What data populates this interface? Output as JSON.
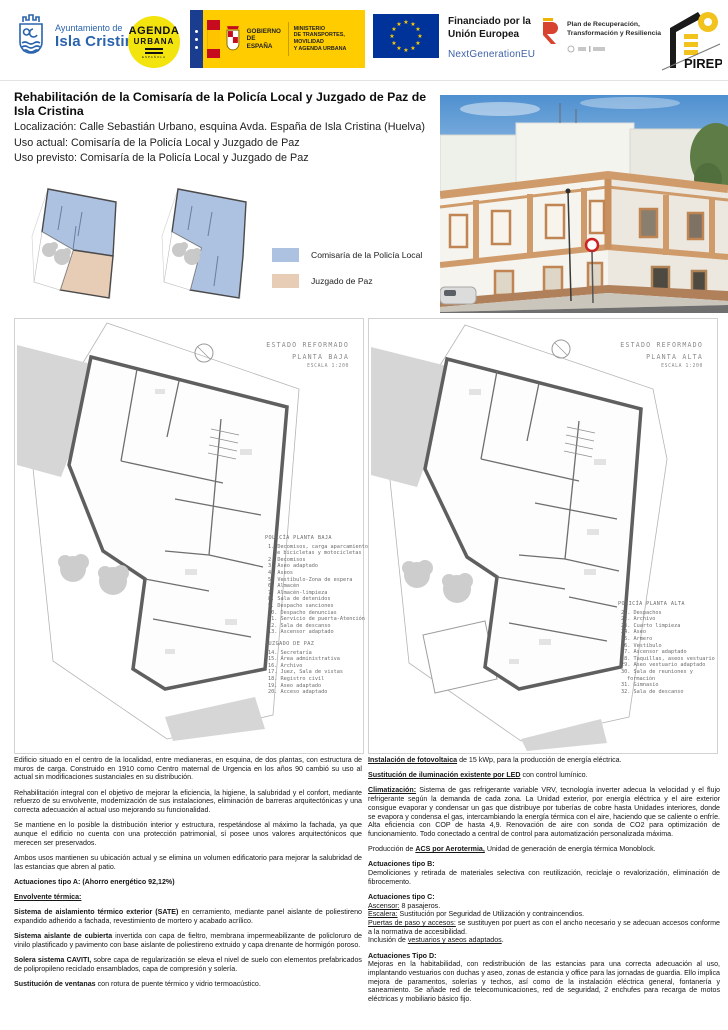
{
  "header": {
    "ayuntamiento": {
      "line1": "Ayuntamiento de",
      "line2": "Isla Cristina"
    },
    "agenda": {
      "line1": "AGENDA",
      "line2": "URBANA",
      "line3": "ESPAÑOLA"
    },
    "gobierno": {
      "name1": "GOBIERNO",
      "name2": "DE ESPAÑA",
      "min1": "MINISTERIO",
      "min2": "DE TRANSPORTES, MOVILIDAD",
      "min3": "Y AGENDA URBANA"
    },
    "eu": {
      "funding1": "Financiado por la",
      "funding2": "Unión Europea",
      "program": "NextGenerationEU",
      "flag_color": "#003399",
      "star_color": "#ffcc00"
    },
    "plan": {
      "line1": "Plan de Recuperación,",
      "line2": "Transformación y Resiliencia"
    },
    "pirep": {
      "label": "PIREP"
    }
  },
  "title": "Rehabilitación de la Comisaría de la Policía Local y Juzgado de Paz de Isla Cristina",
  "info": {
    "localizacion": "Localización: Calle Sebastián Urbano, esquina Avda. España de Isla Cristina (Huelva)",
    "uso_actual": "Uso actual: Comisaría de la Policía Local y Juzgado de Paz",
    "uso_previsto": "Uso previsto: Comisaría de la Policía Local y Juzgado de Paz"
  },
  "legend": {
    "items": [
      {
        "label": "Comisaría de la Policía Local",
        "color": "#adc2e1"
      },
      {
        "label": "Juzgado de Paz",
        "color": "#e8cdb6"
      }
    ]
  },
  "plans": {
    "baja": {
      "caption1": "ESTADO REFORMADO",
      "caption2": "PLANTA BAJA",
      "scale": "ESCALA 1:200",
      "policia_title": "POLICÍA PLANTA BAJA",
      "policia_items": [
        "1. Decomisos, carga aparcamiento de bicicletas y motocicletas",
        "2. Decomisos",
        "3. Aseo adaptado",
        "4. Aseos",
        "5. Vestíbulo-Zona de espera",
        "6. Almacén",
        "7. Almacén-limpieza",
        "8. Sala de detenidos",
        "9. Despacho sanciones",
        "10. Despacho denuncias",
        "11. Servicio de puerta-Atención",
        "12. Sala de descanso",
        "13. Ascensor adaptado"
      ],
      "juzgado_title": "JUZGADO DE PAZ",
      "juzgado_items": [
        "14. Secretaría",
        "15. Área administrativa",
        "16. Archivo",
        "17. Juez, Sala de vistas",
        "18. Registro civil",
        "19. Aseo adaptado",
        "20. Acceso adaptado"
      ]
    },
    "alta": {
      "caption1": "ESTADO REFORMADO",
      "caption2": "PLANTA ALTA",
      "scale": "ESCALA 1:200",
      "policia_title": "POLICÍA PLANTA ALTA",
      "policia_items": [
        "21. Despachos",
        "22. Archivo",
        "23. Cuarto limpieza",
        "24. Aseo",
        "25. Armero",
        "26. Vestíbulo",
        "27. Ascensor adaptado",
        "28. Taquillas, aseos vestuario",
        "29. Aseo vestuario adaptado",
        "30. Sala de reuniones y formación",
        "31. Gimnasio",
        "32. Sala de descanso"
      ]
    }
  },
  "body": {
    "left": [
      {
        "runs": [
          {
            "t": "Edificio situado en el centro de la localidad, entre medianeras, en esquina, de dos plantas, con estructura de muros de carga. Construido en 1910 como Centro maternal de Urgencia en los años 90 cambió su uso al actual sin modificaciones sustanciales en su distribución."
          }
        ]
      },
      {
        "runs": [
          {
            "t": "Rehabilitación integral con el objetivo de mejorar la eficiencia, la higiene, la salubridad y el confort, mediante refuerzo de su envolvente, modernización de sus instalaciones, eliminación de barreras arquitectónicas y una correcta adecuación al actual uso mejorando su funcionalidad."
          }
        ]
      },
      {
        "runs": [
          {
            "t": "Se mantiene en lo posible la distribución interior y estructura, respetándose al máximo la fachada, ya que aunque el edificio no cuenta con una protección patrimonial, sí posee unos valores arquitectónicos que merecen ser preservados."
          }
        ]
      },
      {
        "runs": [
          {
            "t": "Ambos usos mantienen su ubicación actual y se elimina un volumen edificatorio para mejorar la salubridad de las estancias que abren al patio."
          }
        ]
      },
      {
        "runs": [
          {
            "t": " Actuaciones tipo A: (Ahorro energético 92,12%)",
            "b": 1
          }
        ]
      },
      {
        "runs": [
          {
            "t": "Envolvente térmica:",
            "b": 1,
            "u": 1
          }
        ]
      },
      {
        "runs": [
          {
            "t": "Sistema de aislamiento térmico exterior (SATE)",
            "b": 1
          },
          {
            "t": " en cerramiento, mediante panel aislante de poliestireno expandido adherido a fachada, revestimiento de mortero y acabado acrílico."
          }
        ]
      },
      {
        "runs": [
          {
            "t": "Sistema aislante de cubierta",
            "b": 1
          },
          {
            "t": " invertida con capa de fieltro, membrana impermeabilizante de policloruro de vinilo plastificado y pavimento con base aislante de poliestireno extruido y capa drenante de hormigón poroso."
          }
        ]
      },
      {
        "runs": [
          {
            "t": "Solera sistema CAVITI,",
            "b": 1
          },
          {
            "t": " sobre capa de regularización se eleva el nivel de suelo con elementos prefabricados de polipropileno reciclado ensamblados, capa de compresión y solería."
          }
        ]
      },
      {
        "runs": [
          {
            "t": "Sustitución de ventanas",
            "b": 1
          },
          {
            "t": " con rotura de puente térmico y vidrio termoacústico."
          }
        ]
      }
    ],
    "right": [
      {
        "runs": [
          {
            "t": "Instalación de fotovoltaica",
            "b": 1,
            "u": 1
          },
          {
            "t": " de 15 kWp, para la producción de energía eléctrica."
          }
        ]
      },
      {
        "runs": [
          {
            "t": "Sustitución de iluminación existente por LED",
            "b": 1,
            "u": 1
          },
          {
            "t": " con control lumínico."
          }
        ]
      },
      {
        "runs": [
          {
            "t": "Climatización:",
            "b": 1,
            "u": 1
          },
          {
            "t": " Sistema de gas refrigerante variable VRV, tecnología inverter adecua la velocidad y el flujo refrigerante según la demanda de cada zona. La Unidad exterior, por energía eléctrica y el aire exterior consigue evaporar y condensar un gas que distribuye por tuberías de cobre hasta Unidades interiores, donde se evapora y condensa el gas, intercambiando la energía térmica con el aire, haciendo que se caliente o enfríe. Alta eficiencia con COP de hasta 4,9. Renovación de aire con sonda de CO2 para optimización de funcionamiento. Todo conectado a central de control para automatización personalizada máxima."
          }
        ]
      },
      {
        "runs": [
          {
            "t": "Producción de "
          },
          {
            "t": "ACS por Aerotermia,",
            "b": 1,
            "u": 1
          },
          {
            "t": " Unidad de generación de energía térmica Monoblock."
          }
        ]
      },
      {
        "runs": [
          {
            "t": "Actuaciones tipo B:",
            "b": 1
          }
        ]
      },
      {
        "tight": 1,
        "runs": [
          {
            "t": "Demoliciones y retirada de materiales selectiva con reutilización, reciclaje o revalorización, eliminación de fibrocemento."
          }
        ]
      },
      {
        "runs": [
          {
            "t": "Actuaciones tipo C:",
            "b": 1
          }
        ]
      },
      {
        "tight": 1,
        "runs": [
          {
            "t": "Ascensor:",
            "u": 1
          },
          {
            "t": " 8 pasajeros."
          }
        ]
      },
      {
        "tight": 1,
        "runs": [
          {
            "t": "Escalera:",
            "u": 1
          },
          {
            "t": " Sustitución por Seguridad de Utilización y contraincendios."
          }
        ]
      },
      {
        "tight": 1,
        "runs": [
          {
            "t": "Puertas de paso y accesos:",
            "u": 1
          },
          {
            "t": " se sustituyen por puert as con el ancho necesario y se adecuan accesos conforme a la normativa de accesibilidad."
          }
        ]
      },
      {
        "tight": 1,
        "runs": [
          {
            "t": "Inclusión de "
          },
          {
            "t": "vestuarios y aseos adaptados",
            "u": 1
          },
          {
            "t": "."
          }
        ]
      },
      {
        "runs": [
          {
            "t": "Actuaciones Tipo D:",
            "b": 1
          }
        ]
      },
      {
        "tight": 1,
        "runs": [
          {
            "t": "Mejoras en la habitabilidad, con redistribución de las estancias para una correcta adecuación al uso, implantando vestuarios con duchas y aseo, zonas de estancia y office para las jornadas de guardia. Ello implica mejora de paramentos, solerías y techos, así como de la instalación eléctrica general, fontanería y saneamiento. Se añade red de telecomunicaciones, red de seguridad, 2 enchufes para recarga de motos eléctricas y mobiliario básico fijo."
          }
        ]
      }
    ]
  }
}
